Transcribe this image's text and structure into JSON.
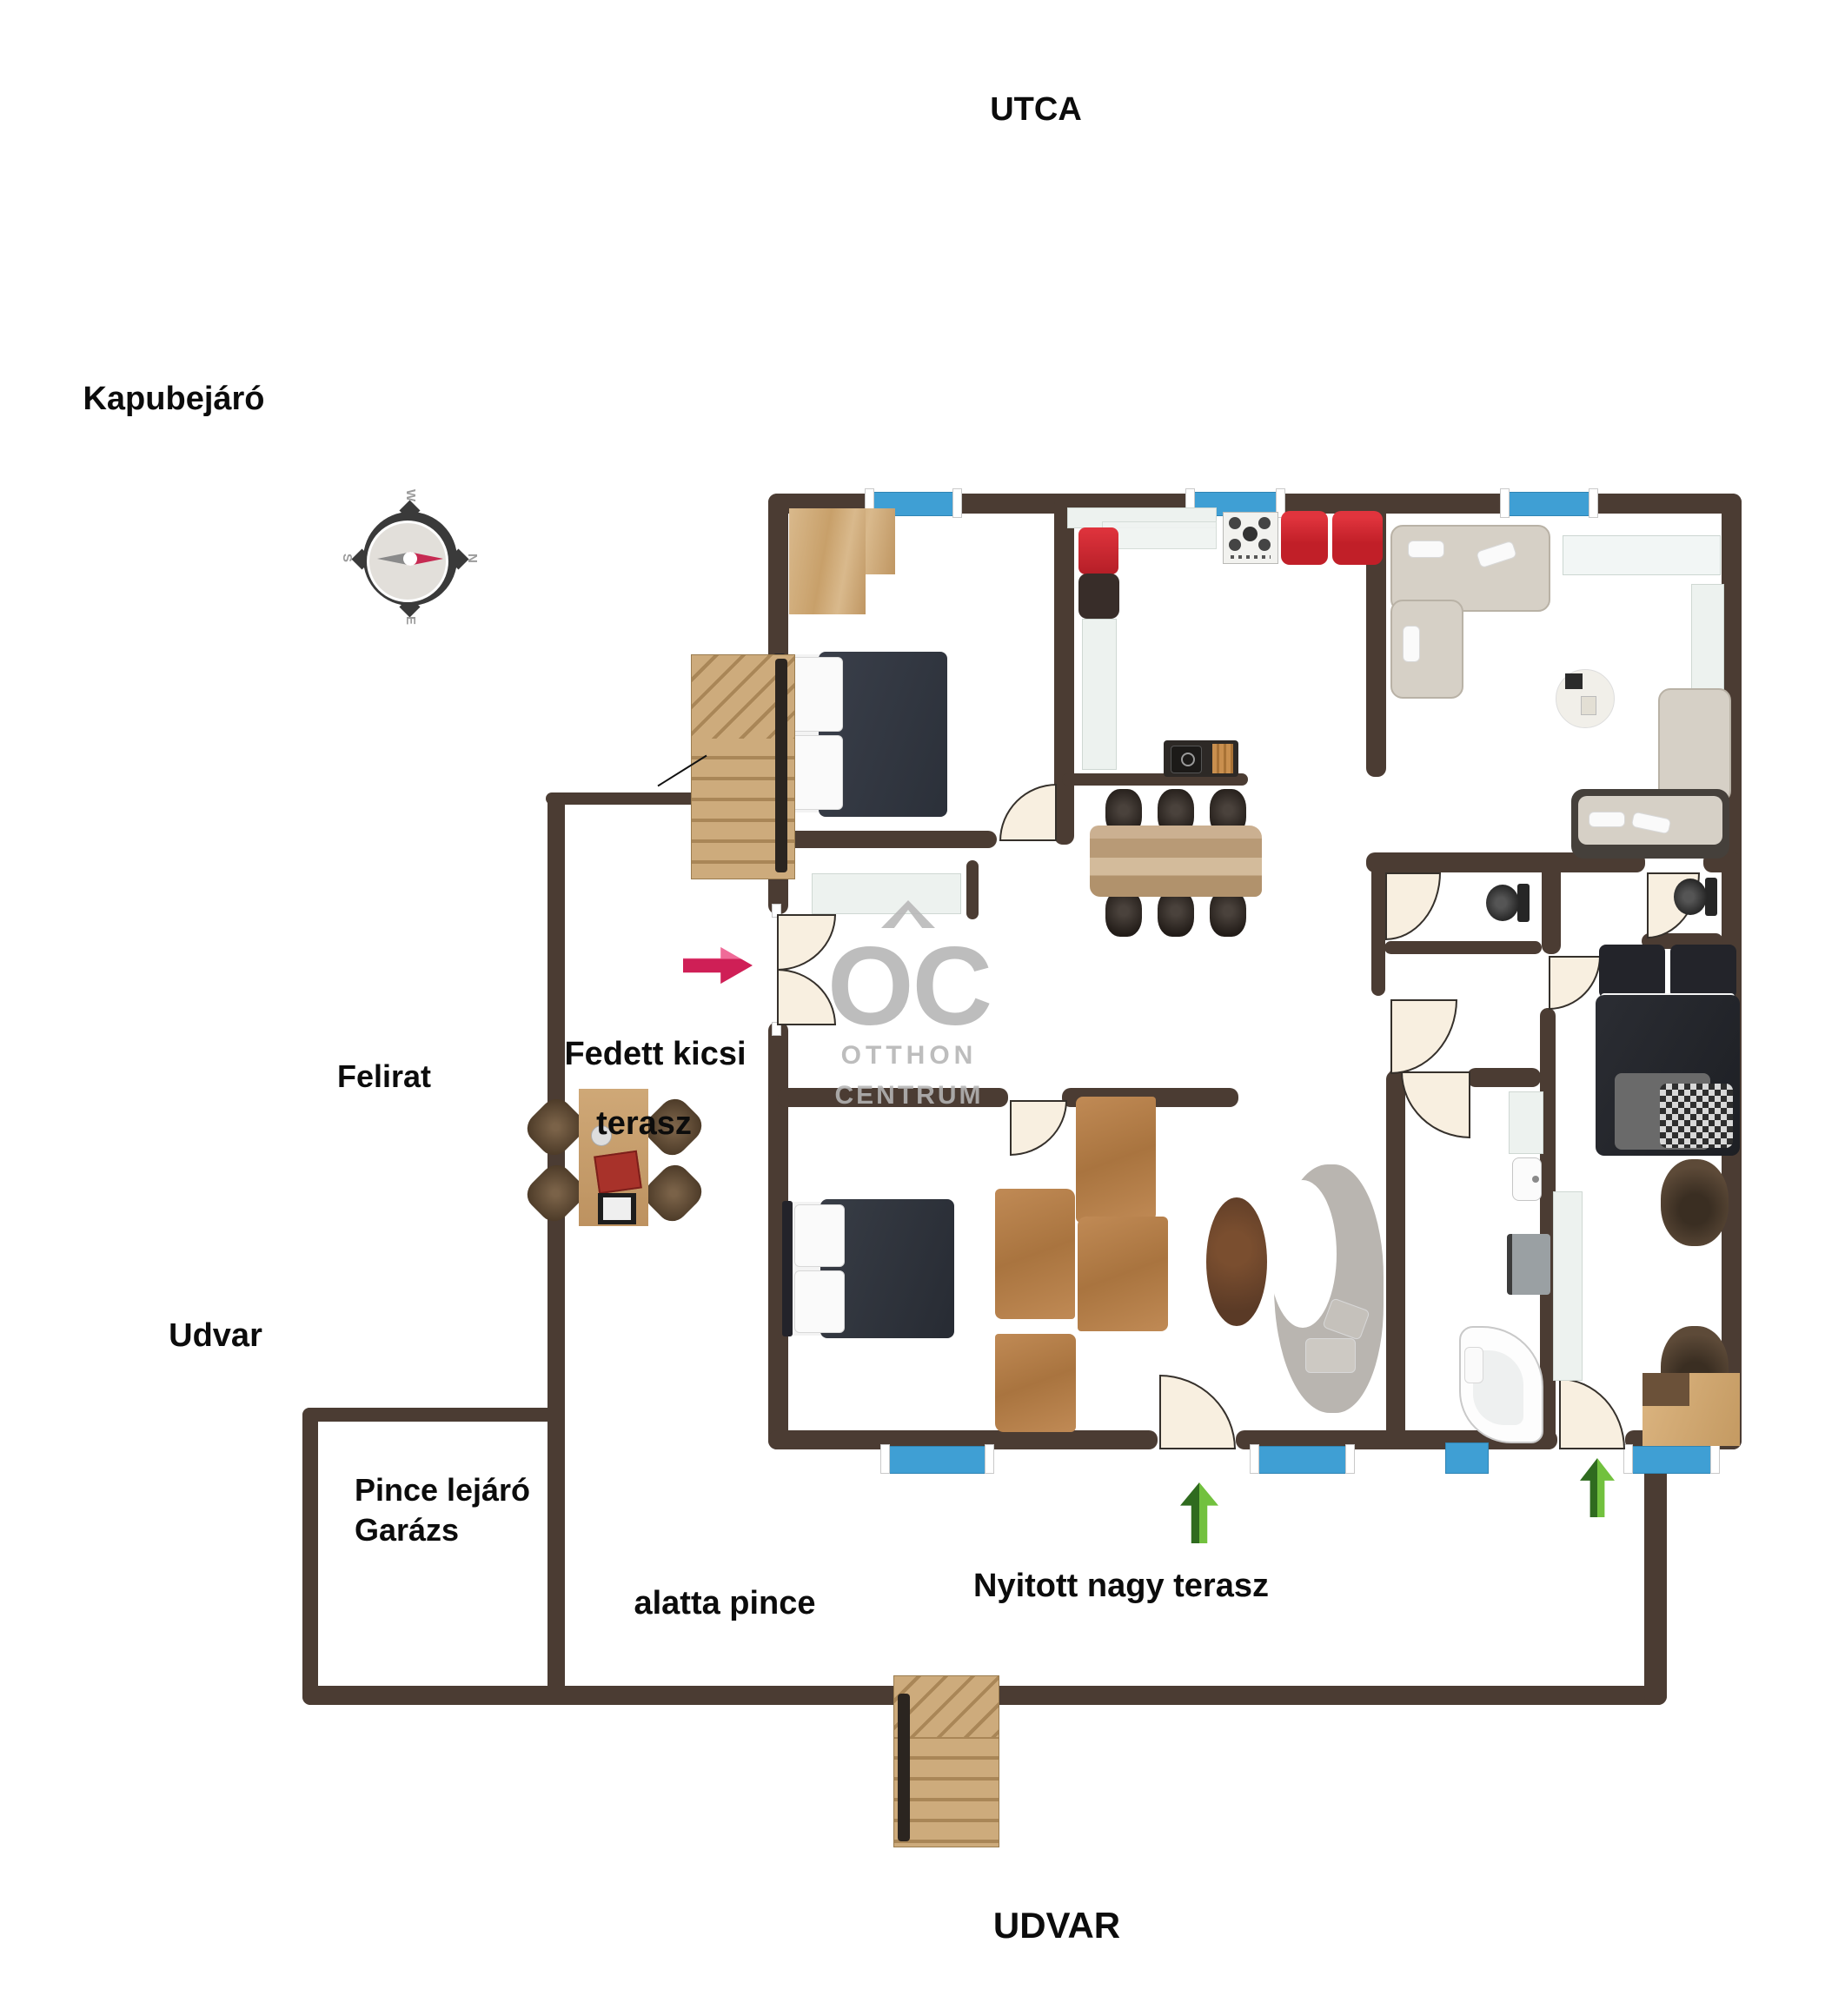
{
  "labels": {
    "utca": "UTCA",
    "kapubejaro": "Kapubejáró",
    "felirat": "Felirat",
    "fedett_kicsi": "Fedett kicsi",
    "terasz": "terasz",
    "udvar_left": "Udvar",
    "pince_lejaro": "Pince lejáró",
    "garazs": "Garázs",
    "alatta_pince": "alatta pince",
    "nyitott_nagy_terasz": "Nyitott nagy terasz",
    "udvar_bottom": "UDVAR"
  },
  "watermark": {
    "initials": "OC",
    "line1": "OTTHON",
    "line2": "CENTRUM"
  },
  "compass": {
    "n": "N",
    "e": "E",
    "s": "S",
    "w": "W"
  },
  "icons": {
    "entry_direction": "pink-right-arrow-icon",
    "terrace_access_1": "green-up-arrow-icon",
    "terrace_access_2": "green-up-arrow-icon",
    "compass": "compass-rose-icon",
    "watermark_caret": "roof-caret-icon"
  },
  "colors": {
    "wall": "#4b3c33",
    "window": "#3f9fd4",
    "kitchen_red": "#cf2730",
    "door": "#f8efe0",
    "arrow_pink": "#d62a5e",
    "arrow_green_dark": "#2f6b1f",
    "arrow_green_light": "#72c13e",
    "wood": "#c9a274",
    "watermark_gray": "#b5b5b5"
  }
}
